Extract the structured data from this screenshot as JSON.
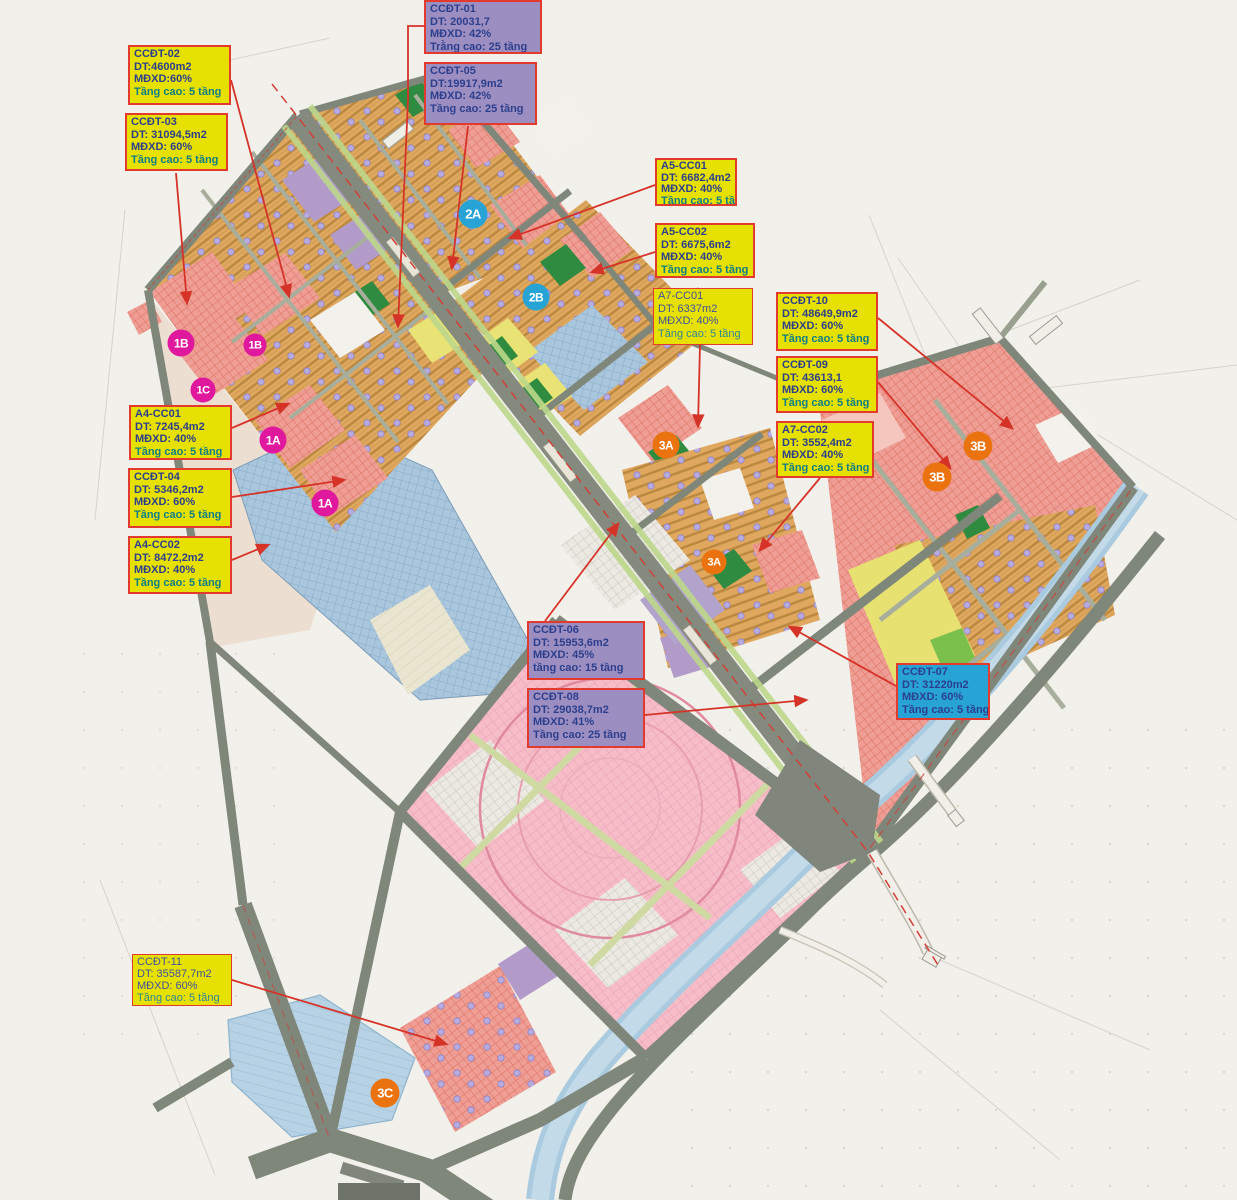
{
  "map_type": "urban-zoning-plan",
  "colors": {
    "background": "#f2f0ea",
    "label_yellow": "#e7e003",
    "label_purple": "#9c8ec0",
    "label_cyan": "#27a3d6",
    "label_border_red": "#e23b2e",
    "label_text_navy": "#2c3f8e",
    "label_text_teal": "#0e7e86",
    "marker_magenta": "#e0189e",
    "marker_cyan": "#27a3d6",
    "marker_orange": "#ea7310",
    "arrow_red": "#d63328",
    "road_gray": "#7f867a",
    "zone_orange_rows": "#e0a75e",
    "zone_red_hatch": "#ee9e94",
    "zone_pink_hatch": "#f6bdc9",
    "zone_blue_hatch": "#a9c6dd",
    "zone_yellow": "#e7e172",
    "zone_green": "#2f8b3f",
    "zone_purple": "#b29bc9",
    "water": "#a9cadf"
  },
  "labels": [
    {
      "id": "CCDT-01",
      "variant": "purple",
      "title": "CCĐT-01",
      "area": "DT: 20031,7",
      "density": "MĐXD: 42%",
      "floors": "Trằng cao: 25 tầng"
    },
    {
      "id": "CCDT-05",
      "variant": "purple",
      "title": "CCĐT-05",
      "area": "DT:19917,9m2",
      "density": "MĐXD: 42%",
      "floors": "Tầng cao: 25 tầng"
    },
    {
      "id": "CCDT-02",
      "variant": "yellow",
      "title": "CCĐT-02",
      "area": "DT:4600m2",
      "density": "MĐXD:60%",
      "floors": "Tầng cao: 5 tầng"
    },
    {
      "id": "CCDT-03",
      "variant": "yellow",
      "title": "CCĐT-03",
      "area": "DT: 31094,5m2",
      "density": "MĐXD: 60%",
      "floors": "Tầng cao: 5 tầng"
    },
    {
      "id": "A5-CC01",
      "variant": "yellow",
      "title": "A5-CC01",
      "area": "DT: 6682,4m2",
      "density": "MĐXD: 40%",
      "floors": "Tầng cao: 5 tầng"
    },
    {
      "id": "A5-CC02",
      "variant": "yellow",
      "title": "A5-CC02",
      "area": "DT: 6675,6m2",
      "density": "MĐXD: 40%",
      "floors": "Tầng cao: 5 tầng"
    },
    {
      "id": "A7-CC01",
      "variant": "yellow-thin",
      "title": "A7-CC01",
      "area": "DT: 6337m2",
      "density": "MĐXD: 40%",
      "floors": "Tầng cao: 5 tầng"
    },
    {
      "id": "CCDT-10",
      "variant": "yellow",
      "title": "CCĐT-10",
      "area": "DT: 48649,9m2",
      "density": "MĐXD: 60%",
      "floors": "Tầng cao: 5 tầng"
    },
    {
      "id": "CCDT-09",
      "variant": "yellow",
      "title": "CCĐT-09",
      "area": "DT: 43613,1",
      "density": "MĐXD: 60%",
      "floors": "Tầng cao: 5 tầng"
    },
    {
      "id": "A7-CC02",
      "variant": "yellow",
      "title": "A7-CC02",
      "area": "DT: 3552,4m2",
      "density": "MĐXD: 40%",
      "floors": "Tầng cao: 5 tầng"
    },
    {
      "id": "A4-CC01",
      "variant": "yellow",
      "title": "A4-CC01",
      "area": "DT: 7245,4m2",
      "density": "MĐXD: 40%",
      "floors": "Tầng cao: 5 tầng"
    },
    {
      "id": "CCDT-04",
      "variant": "yellow",
      "title": "CCĐT-04",
      "area": "DT: 5346,2m2",
      "density": "MĐXD: 60%",
      "floors": "Tầng cao: 5 tầng"
    },
    {
      "id": "A4-CC02",
      "variant": "yellow",
      "title": "A4-CC02",
      "area": "DT: 8472,2m2",
      "density": "MĐXD: 40%",
      "floors": "Tầng cao: 5 tầng"
    },
    {
      "id": "CCDT-06",
      "variant": "purple",
      "title": "CCĐT-06",
      "area": "DT: 15953,6m2",
      "density": "MĐXD: 45%",
      "floors": "tầng cao: 15 tầng"
    },
    {
      "id": "CCDT-08",
      "variant": "purple",
      "title": "CCĐT-08",
      "area": "DT: 29038,7m2",
      "density": "MĐXD: 41%",
      "floors": "Tầng cao: 25 tầng"
    },
    {
      "id": "CCDT-07",
      "variant": "cyan",
      "title": "CCĐT-07",
      "area": "DT: 31220m2",
      "density": "MĐXD: 60%",
      "floors": "Tầng cao: 5 tầng"
    },
    {
      "id": "CCDT-11",
      "variant": "yellow-thin",
      "title": "CCĐT-11",
      "area": "DT: 35587,7m2",
      "density": "MĐXD: 60%",
      "floors": "Tầng cao: 5 tầng"
    }
  ],
  "markers": [
    {
      "label": "1B",
      "color": "magenta"
    },
    {
      "label": "1B",
      "color": "magenta"
    },
    {
      "label": "1C",
      "color": "magenta"
    },
    {
      "label": "1A",
      "color": "magenta"
    },
    {
      "label": "1A",
      "color": "magenta"
    },
    {
      "label": "2A",
      "color": "cyan"
    },
    {
      "label": "2B",
      "color": "cyan"
    },
    {
      "label": "3A",
      "color": "orange"
    },
    {
      "label": "3A",
      "color": "orange"
    },
    {
      "label": "3B",
      "color": "orange"
    },
    {
      "label": "3B",
      "color": "orange"
    },
    {
      "label": "3C",
      "color": "orange"
    }
  ]
}
